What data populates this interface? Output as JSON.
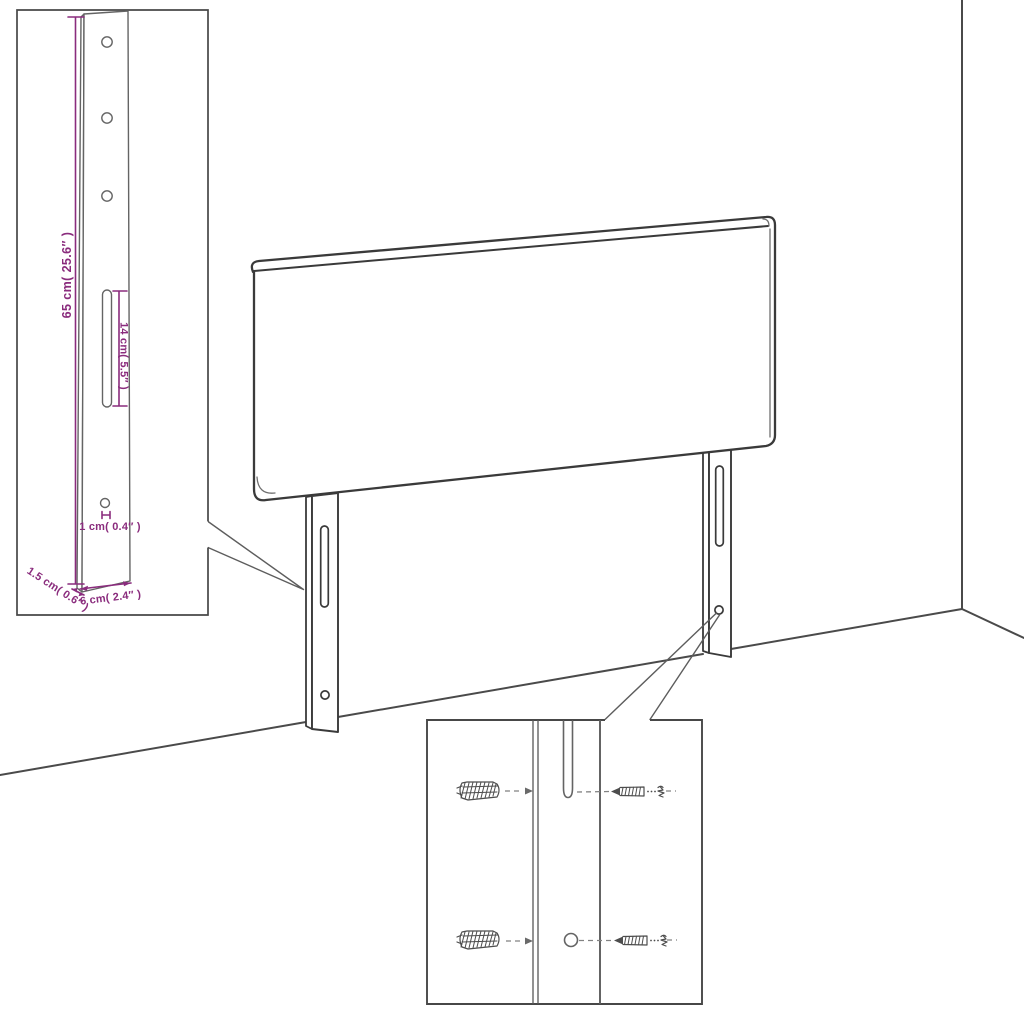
{
  "diagram": {
    "kind": "headboard assembly dimension diagram",
    "colors": {
      "dimension_annotation": "#8a2c7d",
      "line_art": "#3a3a3a",
      "detail_line_art": "#646464",
      "background": "#ffffff"
    },
    "inset_leg_detail": {
      "height_label": "65 cm( 25.6″ )",
      "slot_label": "14 cm( 5.5″ )",
      "hole_label": "1 cm( 0.4″ )",
      "thickness_label": "1.5 cm( 0.6″ )",
      "width_label": "6 cm( 2.4″ )"
    },
    "mounting_detail": {
      "parts": [
        "wall-anchor",
        "wall-anchor",
        "screw",
        "screw"
      ]
    }
  }
}
